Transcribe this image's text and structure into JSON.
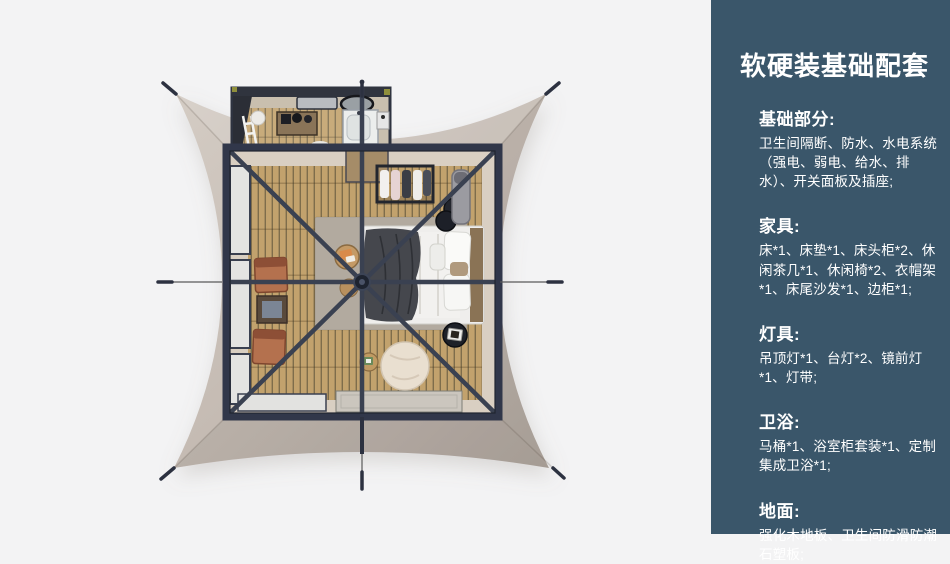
{
  "panel": {
    "title": "软硬装基础配套",
    "sections": [
      {
        "heading": "基础部分:",
        "body": "卫生间隔断、防水、水电系统（强电、弱电、给水、排水）、开关面板及插座;"
      },
      {
        "heading": "家具:",
        "body": "床*1、床垫*1、床头柜*2、休闲茶几*1、休闲椅*2、衣帽架*1、床尾沙发*1、边柜*1;"
      },
      {
        "heading": "灯具:",
        "body": "吊顶灯*1、台灯*2、镜前灯*1、灯带;"
      },
      {
        "heading": "卫浴:",
        "body": "马桶*1、浴室柜套装*1、定制集成卫浴*1;"
      },
      {
        "heading": "地面:",
        "body": "强化木地板、卫生间防滑防潮石塑板;"
      }
    ],
    "colors": {
      "panel_bg": "#3a566a",
      "text": "#ffffff"
    }
  },
  "illustration": {
    "label": "top-down-render-of-glamping-tent-room",
    "colors": {
      "background": "#f3f3f4",
      "tent_canvas": "#c0b6ae",
      "frame": "#343a49",
      "wood_floor": "#c2a26d",
      "rug": "#b2aa9f",
      "bed_linen": "#f1f0ee",
      "blanket": "#45474d",
      "chairs": "#b4714e"
    }
  }
}
